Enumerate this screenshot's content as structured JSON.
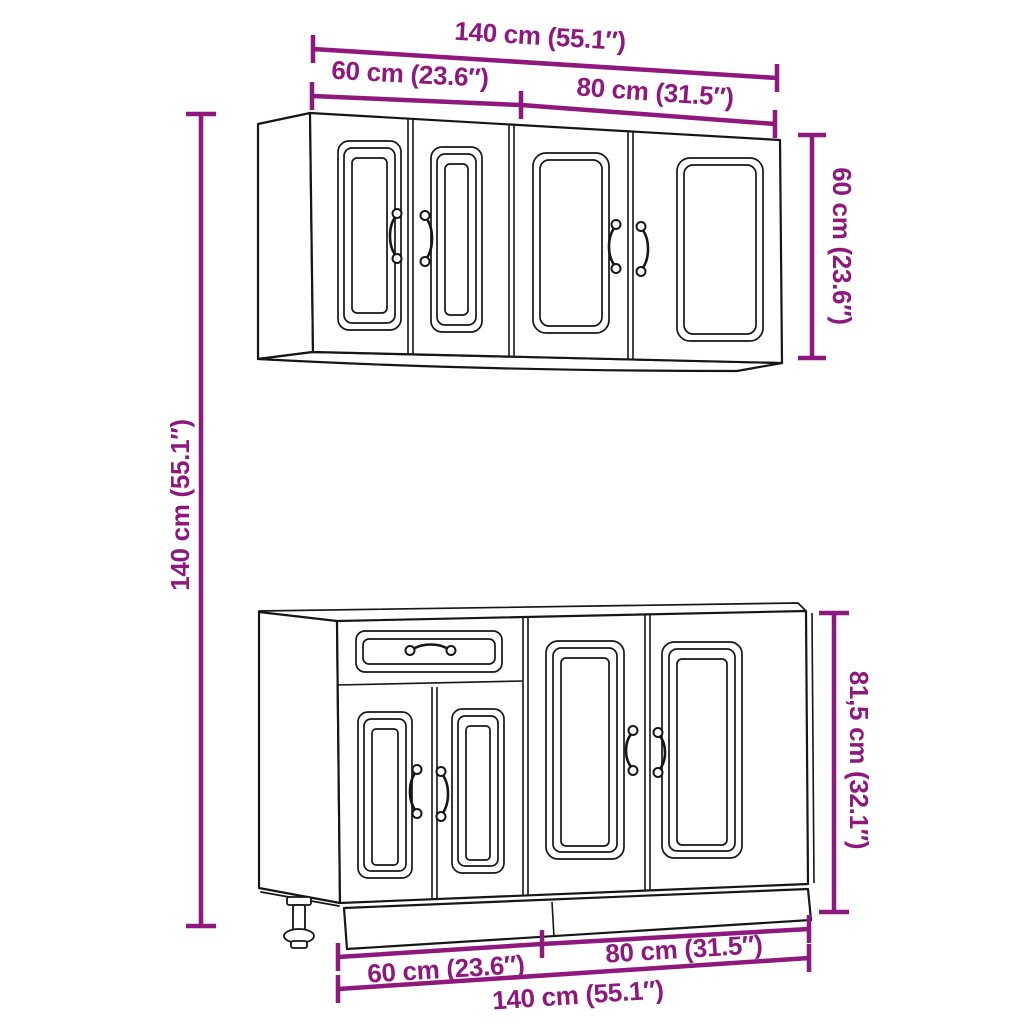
{
  "colors": {
    "dimension": "#8E187E",
    "line": "#161616",
    "background": "#FFFFFF"
  },
  "wall_cabinet": {
    "width_total": "140 cm (55.1″)",
    "width_left_unit": "60 cm (23.6″)",
    "width_right_unit": "80 cm (31.5″)",
    "height": "60 cm (23.6″)"
  },
  "base_cabinet": {
    "height": "81,5 cm (32.1″)",
    "width_left_unit": "60 cm (23.6″)",
    "width_right_unit": "80 cm (31.5″)",
    "width_total": "140 cm (55.1″)"
  },
  "overall": {
    "height": "140 cm (55.1″)"
  }
}
